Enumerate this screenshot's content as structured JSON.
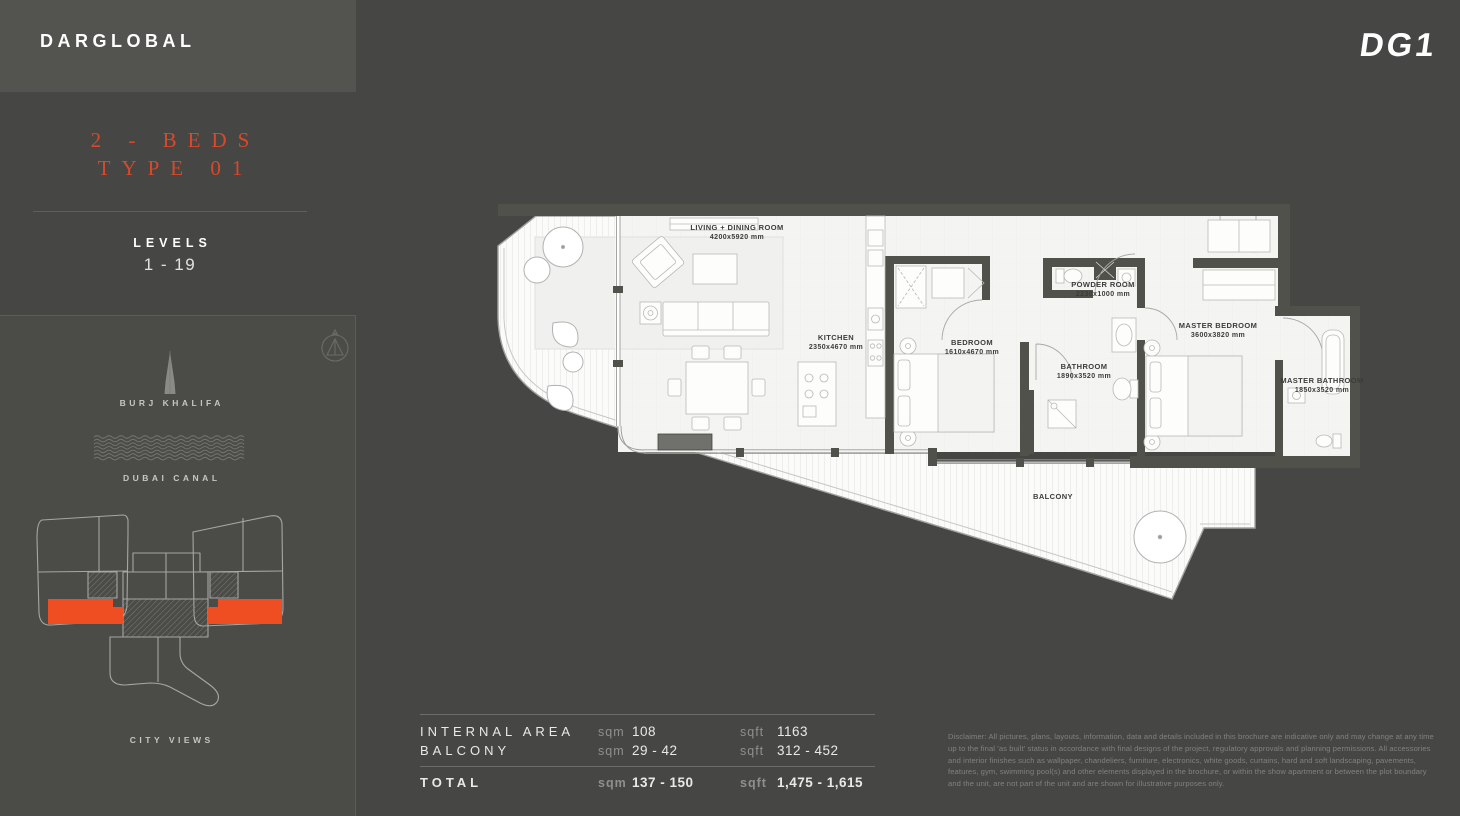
{
  "brand": {
    "logo": "DARGLOBAL",
    "project_logo": "DG1"
  },
  "sidebar": {
    "unit_type_line1": "2 - BEDS",
    "unit_type_line2": "TYPE 01",
    "levels_label": "LEVELS",
    "levels_value": "1 - 19",
    "burj_label": "BURJ KHALIFA",
    "canal_label": "DUBAI CANAL",
    "views_label": "CITY VIEWS",
    "accent_color": "#d8492b",
    "highlight_color": "#ef4e22"
  },
  "floor_plan": {
    "rooms": [
      {
        "name": "LIVING + DINING ROOM",
        "dims": "4200x5920 mm"
      },
      {
        "name": "KITCHEN",
        "dims": "2350x4670 mm"
      },
      {
        "name": "BEDROOM",
        "dims": "1610x4670 mm"
      },
      {
        "name": "POWDER ROOM",
        "dims": "2230x1000 mm"
      },
      {
        "name": "BATHROOM",
        "dims": "1890x3520 mm"
      },
      {
        "name": "MASTER BEDROOM",
        "dims": "3600x3820 mm"
      },
      {
        "name": "MASTER BATHROOM",
        "dims": "1850x3520 mm"
      },
      {
        "name": "BALCONY",
        "dims": ""
      }
    ]
  },
  "area_table": {
    "rows": [
      {
        "label": "INTERNAL AREA",
        "sqm_label": "sqm",
        "sqm": "108",
        "sqft_label": "sqft",
        "sqft": "1163"
      },
      {
        "label": "BALCONY",
        "sqm_label": "sqm",
        "sqm": "29 - 42",
        "sqft_label": "sqft",
        "sqft": "312 - 452"
      }
    ],
    "total": {
      "label": "TOTAL",
      "sqm_label": "sqm",
      "sqm": "137 - 150",
      "sqft_label": "sqft",
      "sqft": "1,475 - 1,615"
    }
  },
  "disclaimer": "Disclaimer: All pictures, plans, layouts, information, data and details included in this brochure are indicative only and may change at any time up to the final 'as built' status in accordance with final designs of the project, regulatory approvals and planning permissions. All accessories and interior finishes such as wallpaper, chandeliers, furniture, electronics, white goods, curtains, hard and soft landscaping, pavements, features, gym, swimming pool(s) and other elements displayed in the brochure, or within the show apartment or between the plot boundary and the unit, are not part of the unit and are shown for illustrative purposes only."
}
